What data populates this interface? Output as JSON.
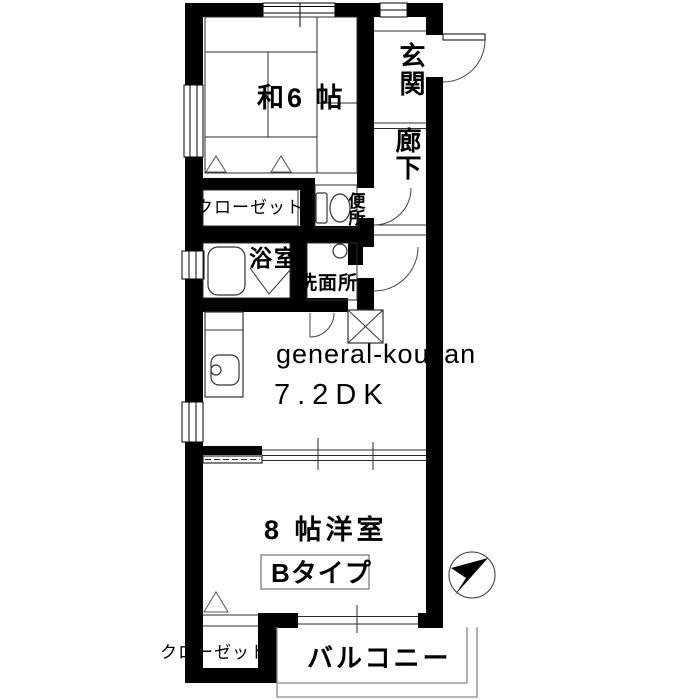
{
  "floor_plan": {
    "watermark": "general-kousan",
    "unit_type_label": "Bタイプ",
    "rooms": {
      "japanese_room": "和6 帖",
      "entrance": "玄関",
      "hallway": "廊下",
      "closet_upper": "クローゼット",
      "toilet": "便所",
      "bathroom": "浴室",
      "washroom": "洗面所",
      "dining_kitchen": "7.2DK",
      "western_room": "8 帖洋室",
      "closet_lower": "クローゼット",
      "balcony": "バルコニー"
    },
    "fixture_icons": [
      "bathtub-icon",
      "toilet-bowl-icon",
      "kitchen-sink-icon",
      "washbasin-icon",
      "washing-machine-pan-icon",
      "compass-north-arrow-icon",
      "door-swing-arc-icon",
      "window-double-line-icon"
    ],
    "colors": {
      "walls": "#000000",
      "background": "#ffffff",
      "thin_lines": "#2b2b2b",
      "balcony_outline": "#8a8a8a",
      "watermark": "#c5c5c5"
    }
  }
}
